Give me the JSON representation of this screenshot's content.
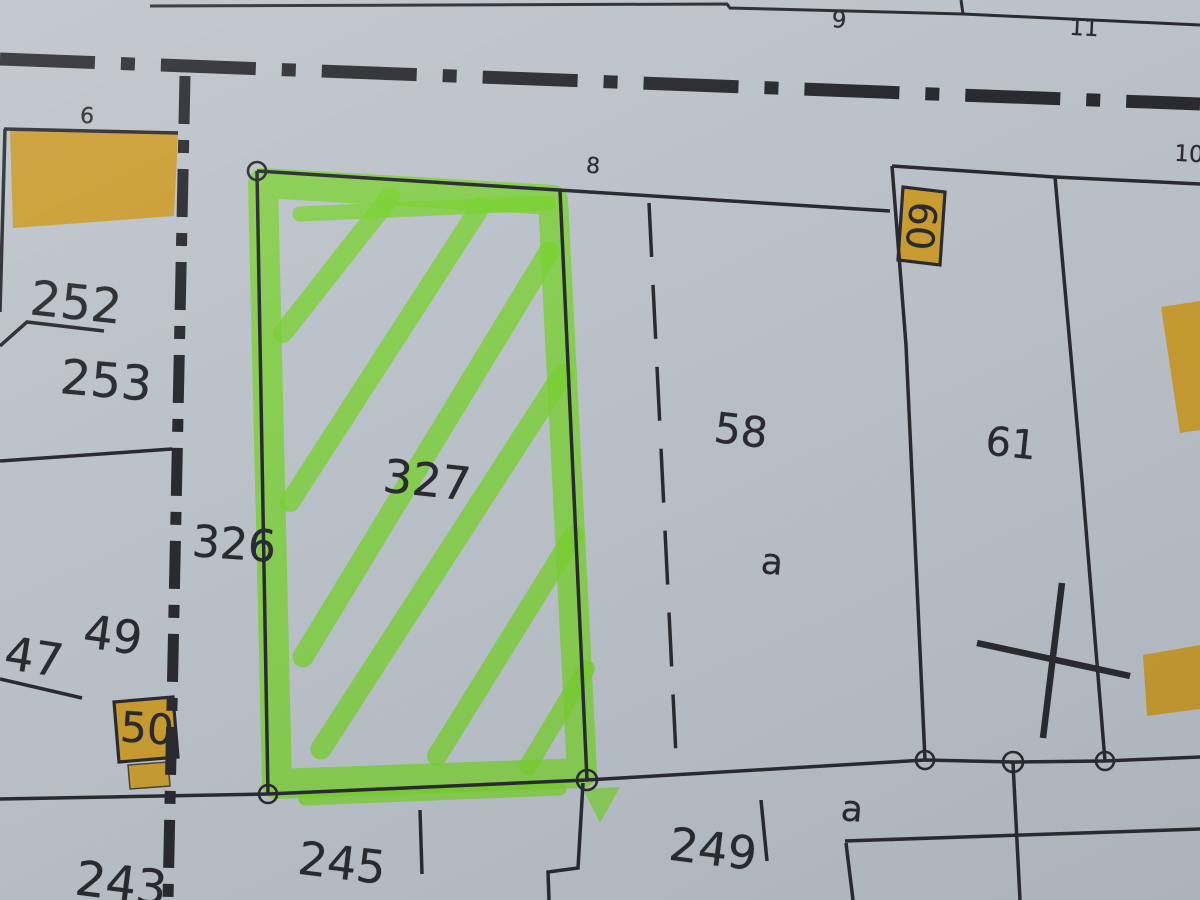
{
  "map": {
    "description_labels_note": "cadastral parcel map photograph",
    "colors": {
      "paper": "#c9cfd6",
      "ink": "#26272b",
      "building": "#d9a62c",
      "highlight": "#7fe02c"
    },
    "labels": [
      {
        "id": "parcel-6",
        "text": "6",
        "x": 87,
        "y": 117,
        "size": 22,
        "rot": 4
      },
      {
        "id": "parcel-8",
        "text": "8",
        "x": 593,
        "y": 167,
        "size": 22,
        "rot": 4
      },
      {
        "id": "parcel-9",
        "text": "9",
        "x": 839,
        "y": 21,
        "size": 23,
        "rot": 3
      },
      {
        "id": "parcel-11",
        "text": "11",
        "x": 1084,
        "y": 29,
        "size": 23,
        "rot": 3
      },
      {
        "id": "parcel-10",
        "text": "10",
        "x": 1189,
        "y": 155,
        "size": 23,
        "rot": 3
      },
      {
        "id": "parcel-252",
        "text": "252",
        "x": 76,
        "y": 303,
        "size": 48,
        "rot": 6
      },
      {
        "id": "parcel-253",
        "text": "253",
        "x": 106,
        "y": 381,
        "size": 48,
        "rot": 5
      },
      {
        "id": "parcel-326",
        "text": "326",
        "x": 234,
        "y": 545,
        "size": 44,
        "rot": 4
      },
      {
        "id": "parcel-327",
        "text": "327",
        "x": 427,
        "y": 480,
        "size": 46,
        "rot": 6
      },
      {
        "id": "parcel-58",
        "text": "58",
        "x": 741,
        "y": 431,
        "size": 42,
        "rot": 7
      },
      {
        "id": "subparcel-a-58",
        "text": "a",
        "x": 772,
        "y": 563,
        "size": 36,
        "rot": 5
      },
      {
        "id": "parcel-61",
        "text": "61",
        "x": 1011,
        "y": 444,
        "size": 40,
        "rot": 6
      },
      {
        "id": "parcel-49",
        "text": "49",
        "x": 113,
        "y": 635,
        "size": 46,
        "rot": 8
      },
      {
        "id": "parcel-47",
        "text": "47",
        "x": 34,
        "y": 657,
        "size": 46,
        "rot": 9
      },
      {
        "id": "house-50",
        "text": "50",
        "x": 147,
        "y": 729,
        "size": 42,
        "rot": 4
      },
      {
        "id": "house-60",
        "text": "60",
        "x": 921,
        "y": 226,
        "size": 38,
        "rot": 96
      },
      {
        "id": "parcel-243",
        "text": "243",
        "x": 121,
        "y": 884,
        "size": 48,
        "rot": 7
      },
      {
        "id": "parcel-245",
        "text": "245",
        "x": 342,
        "y": 863,
        "size": 46,
        "rot": 7
      },
      {
        "id": "parcel-249",
        "text": "249",
        "x": 713,
        "y": 849,
        "size": 46,
        "rot": 7
      },
      {
        "id": "subparcel-a-249",
        "text": "a",
        "x": 852,
        "y": 810,
        "size": 36,
        "rot": 5
      }
    ]
  }
}
